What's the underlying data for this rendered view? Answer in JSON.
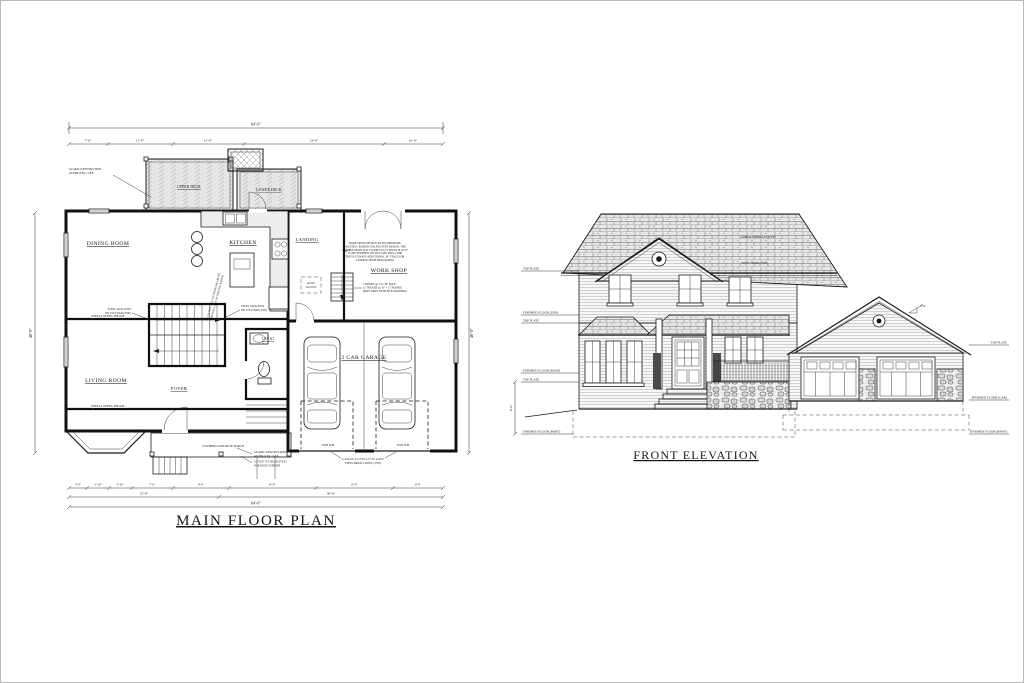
{
  "sheet": {
    "background": "#ffffff",
    "line_color": "#1b1b1b",
    "border_color": "#b9b9b9"
  },
  "floor_plan": {
    "title": "MAIN FLOOR PLAN",
    "rooms": {
      "dining": "DINING ROOM",
      "kitchen": "KITCHEN",
      "landing": "LANDING",
      "workshop": "WORK SHOP",
      "living": "LIVING ROOM",
      "foyer": "FOYER",
      "lav": "LAV #1",
      "garage": "2 CAR GARAGE",
      "porch": "COVERED CONCRETE PORCH",
      "upper_deck": "UPPER DECK",
      "lower_deck": "LOWER DECK"
    },
    "notes": {
      "guard": [
        "GUARD CONSTRUCTION",
        "AS PER O.B.C. 9.8.8."
      ],
      "beam": "W8X24 STEEL BEAM",
      "jack": [
        "STEEL JACK POST",
        "ON 4\"X4\" PAD (TYP.)"
      ],
      "flush": [
        "3-1 3/4\"X14\" LVL FLUSH BEAM ABOVE",
        "THIS WALL (U/S OF CEILING JOISTS)"
      ],
      "truss": [
        "ROOF TRUSS DESIGN TO INCORPORATE",
        "VAULTED / RAISED CEILING INTO DESIGN. THE",
        "GARAGE MAIN FLR. FLOOR TO U/S TRUSS IS 10'-0\"",
        "TO BE VERIFIED ON SITE (SEE DWG). THE",
        "TRUSS TO HAVE ADDITIONAL 24\" STALL FOR",
        "LANDING HIGH HEAD ROOM."
      ],
      "stair": [
        "7 RISERS @ 7-11/16\" MAX.",
        "11 TREADS @ 10\" + 1\" NOSING",
        "(MAY VARY WITH SITE GRADING)"
      ],
      "porch_beam": [
        "3-2\"X10\" P.T. BEAM (TYP.)",
        "FOR ROOF SUPPORT"
      ],
      "lintel": [
        "L-ANGLE 3-1/2\"X3-1/2\" W/ 4-9/16\"",
        "STEEL BRICK LINTEL (TYP.)"
      ],
      "oh_door": "9'X8' O/H",
      "attic": [
        "ATTIC",
        "ACCESS"
      ]
    },
    "dims": {
      "top_overall": "64'-0\"",
      "top_segments": [
        "7'-6\"",
        "11'-0\"",
        "12'-0\"",
        "23'-8\"",
        "10'-0\""
      ],
      "bottom_row1": [
        "3'-0\"",
        "3'-10\"",
        "3'-10\"",
        "7'-0\"",
        "9'-6\"",
        "14'-9\"",
        "13'-0\"",
        "6'-9\""
      ],
      "bottom_row2": [
        "25'-6\"",
        "36'-6\""
      ],
      "bottom_overall": "64'-0\"",
      "left_overall": "46'-0\"",
      "right_overall": "46'-0\""
    }
  },
  "elevation": {
    "title": "FRONT ELEVATION",
    "levels_left": [
      "TOP PLATE",
      "FINISHED FLOOR (2ND)",
      "TOP PLATE",
      "FINISHED FLOOR (MAIN)",
      "TOP PLATE",
      "FINISHED FLOOR (BSMT)"
    ],
    "levels_right": [
      "TOP PLATE",
      "FINISHED FLOOR (GAR)",
      "FINISHED FLOOR (BSMT)"
    ],
    "dim_basement": "9'-0\"",
    "slope": "4/12",
    "notes": {
      "shingles": "ASPHALT SHINGLES (TYP.)",
      "siding": "VINYL SIDING (TYP.)"
    }
  }
}
